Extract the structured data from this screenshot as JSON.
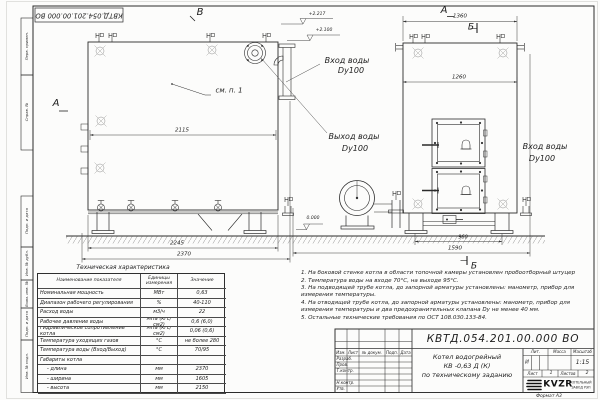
{
  "frame": {
    "stamp_top": "КВТД.054.201.00.000 ВО",
    "format_label": "Формат  А3",
    "margin_labels": [
      "Перв. примен.",
      "Справ. №",
      "Подп. и дата",
      "Инв. № дубл.",
      "Взам. инв. №",
      "Подп. и дата",
      "Инв. № подл."
    ]
  },
  "views": {
    "side_view": {
      "view_label": "В",
      "arrow_label": "А",
      "callout": "см. п. 1",
      "dim_width_inner": "2115",
      "dim_support_span": "2245",
      "dim_length_overall": "2370"
    },
    "front_view": {
      "view_label": "А",
      "section_label_top": "Б",
      "section_label_bottom": "Б",
      "dim_width_overall": "1360",
      "dim_width_inner": "1260",
      "dim_support_span": "960",
      "dim_depth_overall": "1590"
    },
    "elevation_marks": {
      "mark_1": "+2.217",
      "mark_2": "+2.100",
      "mark_zero": "0.000"
    },
    "pipe_labels": {
      "inlet_mid_line1": "Вход воды",
      "inlet_mid_line2": "Dy100",
      "outlet_line1": "Выход воды",
      "outlet_line2": "Dy100",
      "inlet_right_line1": "Вход воды",
      "inlet_right_line2": "Dy100"
    }
  },
  "spec_table": {
    "title": "Техническая характеристика",
    "headers": [
      "Наименование показателя",
      "Единицы измерения",
      "Значение"
    ],
    "rows": [
      {
        "name": "Номинальная мощность",
        "unit": "МВт",
        "value": "0,63"
      },
      {
        "name": "Диапазон рабочего регулирования",
        "unit": "%",
        "value": "40-110"
      },
      {
        "name": "Расход воды",
        "unit": "м3/ч",
        "value": "22"
      },
      {
        "name": "Рабочее давление воды",
        "unit": "МПа (кгс/см2)",
        "value": "0,6 (6,0)"
      },
      {
        "name": "Гидравлическое сопротивление котла",
        "unit": "МПа (кгс/см2)",
        "value": "0,06 (0,6)"
      },
      {
        "name": "Температура уходящих газов",
        "unit": "°С",
        "value": "не более 280"
      },
      {
        "name": "Температура воды (Вход/Выход)",
        "unit": "°С",
        "value": "70/95"
      },
      {
        "name": "Габариты котла",
        "unit": "",
        "value": ""
      },
      {
        "name": "- длина",
        "unit": "мм",
        "value": "2370"
      },
      {
        "name": "- ширина",
        "unit": "мм",
        "value": "1605"
      },
      {
        "name": "- высота",
        "unit": "мм",
        "value": "2150"
      }
    ]
  },
  "notes": {
    "items": [
      "1.  На боковой стенке котла в области топочной камеры установлен пробоотборный штуцер",
      "2.  Температура воды на входе 70°С, на выходе 95°С.",
      "3.  На подводящей трубе котла, до запорной арматуры установлены: манометр, прибор для измерения температуры.",
      "4.  На отводящей трубе котла, до запорной арматуры установлены: манометр, прибор для измерения температуры и два предохранительных клапана Dу не менее 40 мм.",
      "5.  Остальные технические требования по ОСТ 108.030.133-84."
    ]
  },
  "title_block": {
    "doc_number": "КВТД.054.201.00.000  ВО",
    "product_line1": "Котел водогрейный",
    "product_line2": "КВ -0,63 Д (К)",
    "product_line3": "по техническому заданию",
    "col_izm": "Изм.",
    "col_list": "Лист",
    "col_doc": "№ докум.",
    "col_podp": "Подп.",
    "col_data": "Дата",
    "row_razrab": "Разраб.",
    "row_prov": "Пров.",
    "row_tkontr": "Т.контр.",
    "row_nkontr": "Н.контр.",
    "row_utv": "Утв.",
    "lit_label": "Лит.",
    "lit_value": "И",
    "massa_label": "Масса",
    "masshtab_label": "Масштаб",
    "masshtab_value": "1:15",
    "list_label": "Лист",
    "list_value": "1",
    "listov_label": "Листов",
    "listov_value": "2",
    "logo_text": "KVZR",
    "org_line1": "КОТЕЛЬНЫЙ",
    "org_line2": "ЗАВОД РЭП"
  }
}
